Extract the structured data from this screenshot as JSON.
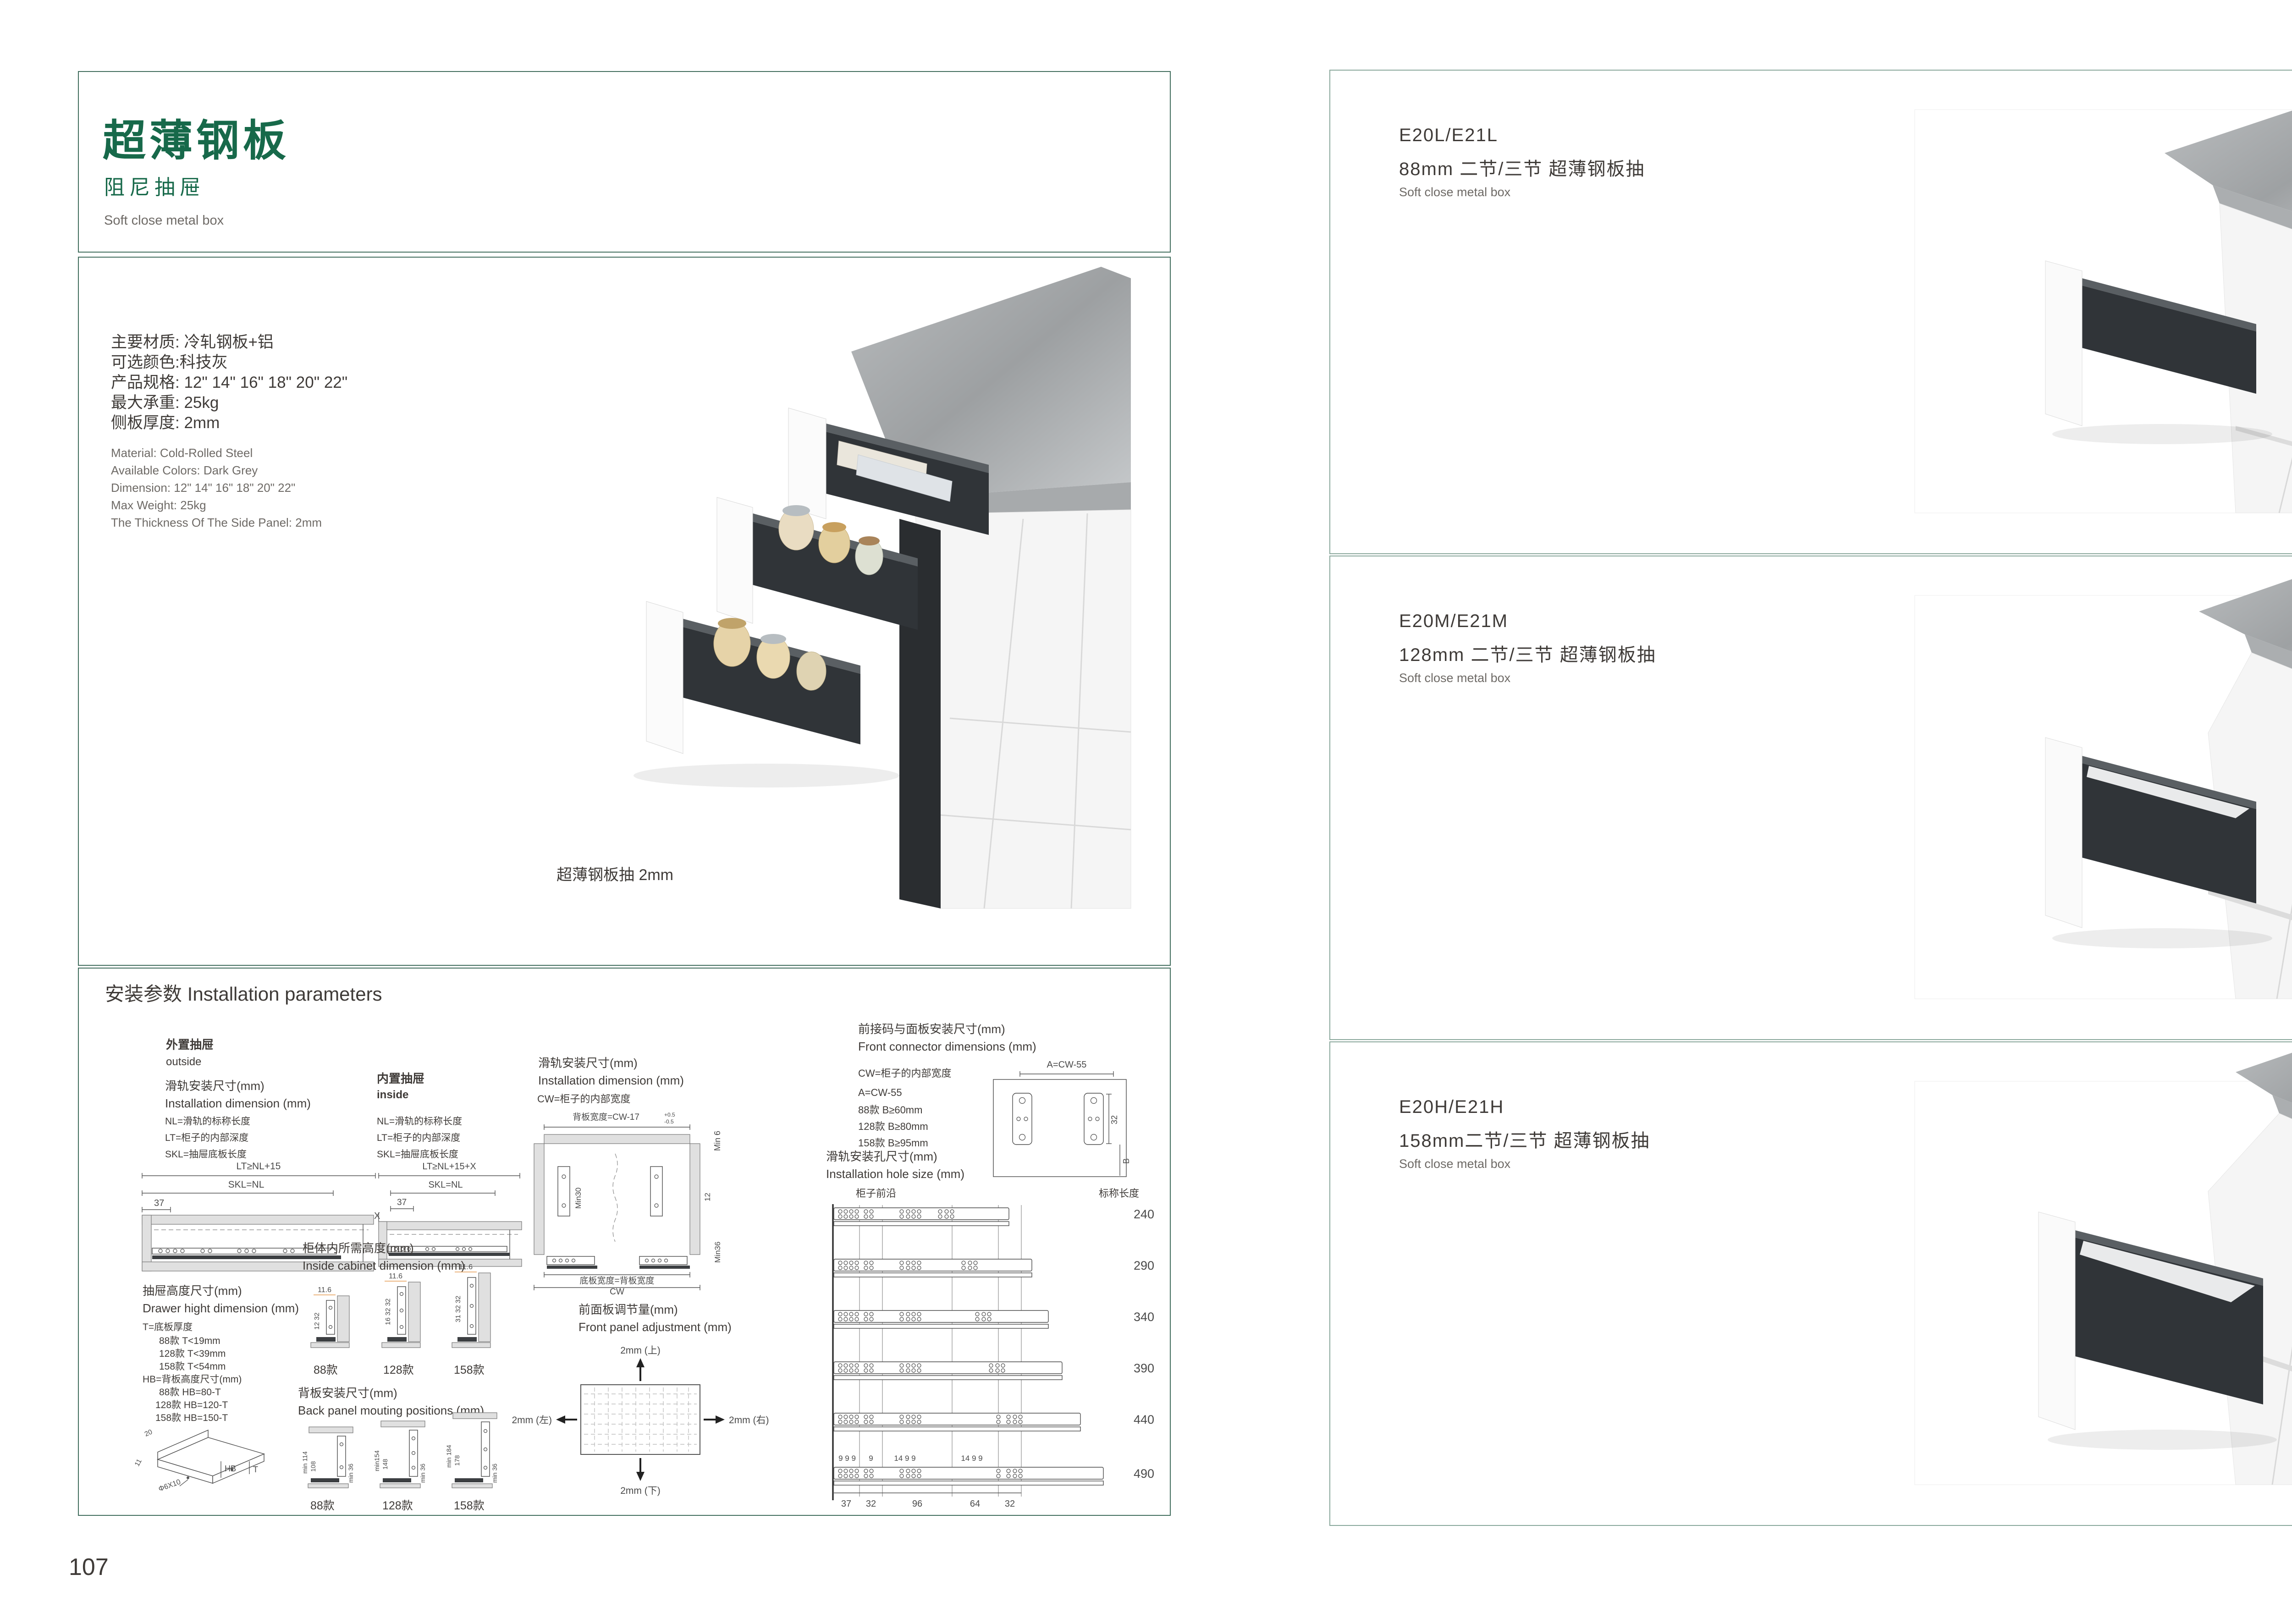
{
  "left_page": {
    "page_number": "107",
    "header": {
      "title": "超薄钢板",
      "subtitle": "阻尼抽屉",
      "subtitle_en": "Soft close metal box"
    },
    "specs_cn": [
      "主要材质: 冷轧钢板+铝",
      "可选颜色:科技灰",
      "产品规格: 12\" 14\" 16\" 18\" 20\" 22\"",
      "最大承重: 25kg",
      "侧板厚度: 2mm"
    ],
    "specs_en": [
      "Material: Cold-Rolled Steel",
      "Available Colors: Dark Grey",
      "Dimension: 12\" 14\" 16\" 18\" 20\" 22\"",
      "Max Weight: 25kg",
      "The Thickness Of The Side Panel: 2mm"
    ],
    "photo_caption": "超薄钢板抽 2mm",
    "install": {
      "title": "安装参数 Installation parameters",
      "outside": {
        "label_cn": "外置抽屉",
        "label_en": "outside",
        "dim_cn": "滑轨安装尺寸(mm)",
        "dim_en": "Installation dimension (mm)",
        "def1": "NL=滑轨的标称长度",
        "def2": "LT=柜子的内部深度",
        "def3": "SKL=抽屉底板长度",
        "lt": "LT≥NL+15",
        "skl": "SKL=NL",
        "offset": "37"
      },
      "inside": {
        "label_cn": "内置抽屉",
        "label_en": "inside",
        "def1": "NL=滑轨的标称长度",
        "def2": "LT=柜子的内部深度",
        "def3": "SKL=抽屉底板长度",
        "lt": "LT≥NL+15+X",
        "skl": "SKL=NL",
        "offset": "37",
        "x": "X"
      },
      "width_dim": {
        "title_cn": "滑轨安装尺寸(mm)",
        "title_en": "Installation dimension (mm)",
        "note": "CW=柜子的内部宽度",
        "back_width": "背板宽度=CW-17",
        "tol_up": "+0.5",
        "tol_dn": "-0.5",
        "min6": "Min 6",
        "min30": "Min30",
        "d12": "12",
        "min36": "Min36",
        "bottom_width": "底板宽度=背板宽度",
        "cw": "CW"
      },
      "connector": {
        "title_cn": "前接码与面板安装尺寸(mm)",
        "title_en": "Front connector  dimensions (mm)",
        "note": "CW=柜子的内部宽度",
        "a": "A=CW-55",
        "b1": "88款   B≥60mm",
        "b2": "128款  B≥80mm",
        "b3": "158款  B≥95mm",
        "dim_a": "A=CW-55",
        "dim_32": "32",
        "dim_b": "B"
      },
      "drawer_height": {
        "title_cn": "抽屉高度尺寸(mm)",
        "title_en": "Drawer hight dimension (mm)",
        "t0": "T=底板厚度",
        "t1": "88款   T<19mm",
        "t2": "128款  T<39mm",
        "t3": "158款  T<54mm",
        "hb0": "HB=背板高度尺寸(mm)",
        "hb1": "88款   HB=80-T",
        "hb2": "128款 HB=120-T",
        "hb3": "158款 HB=150-T",
        "iso_20": "20",
        "iso_11": "11",
        "iso_hole": "Φ6X10",
        "iso_hb": "HB",
        "iso_t": "T"
      },
      "inside_cabinet": {
        "title_cn": "柜体内所需高度(mm)",
        "title_en": "Inside cabinet dimension (mm)",
        "v1_top": "11.6",
        "v1_dims": "12 32",
        "v1_name": "88款",
        "v2_top": "11.6",
        "v2_dims": "16 32 32",
        "v2_name": "128款",
        "v3_top": "11.6",
        "v3_dims": "31 32 32",
        "v3_name": "158款"
      },
      "back_panel": {
        "title_cn": "背板安装尺寸(mm)",
        "title_en": "Back panel mouting positions (mm)",
        "v1_a": "min 114",
        "v1_b": "108",
        "v1_c": "min 36",
        "v1_name": "88款",
        "v2_a": "min154",
        "v2_b": "148",
        "v2_c": "min 36",
        "v2_name": "128款",
        "v3_a": "min 184",
        "v3_b": "178",
        "v3_c": "min 36",
        "v3_name": "158款"
      },
      "front_adjust": {
        "title_cn": "前面板调节量(mm)",
        "title_en": "Front panel adjustment (mm)",
        "up": "2mm (上)",
        "down": "2mm (下)",
        "left": "2mm (左)",
        "right": "2mm (右)"
      },
      "hole_size": {
        "title_cn": "滑轨安装孔尺寸(mm)",
        "title_en": "Installation hole size (mm)",
        "front_edge": "柜子前沿",
        "nominal": "标称长度",
        "len1": "240",
        "len2": "290",
        "len3": "340",
        "len4": "390",
        "len5": "440",
        "len6": "490",
        "top1": "9 9 9",
        "top2": "9",
        "top3": "14 9 9",
        "top4": "14 9 9",
        "bot1": "37",
        "bot2": "32",
        "bot3": "96",
        "bot4": "64",
        "bot5": "32"
      }
    }
  },
  "right_page": {
    "page_number": "108",
    "products": [
      {
        "model": "E20L/E21L",
        "desc_cn": "88mm 二节/三节 超薄钢板抽",
        "desc_en": "Soft close metal box"
      },
      {
        "model": "E20M/E21M",
        "desc_cn": "128mm 二节/三节 超薄钢板抽",
        "desc_en": "Soft close metal box"
      },
      {
        "model": "E20H/E21H",
        "desc_cn": "158mm二节/三节 超薄钢板抽",
        "desc_en": "Soft close metal box"
      }
    ]
  }
}
